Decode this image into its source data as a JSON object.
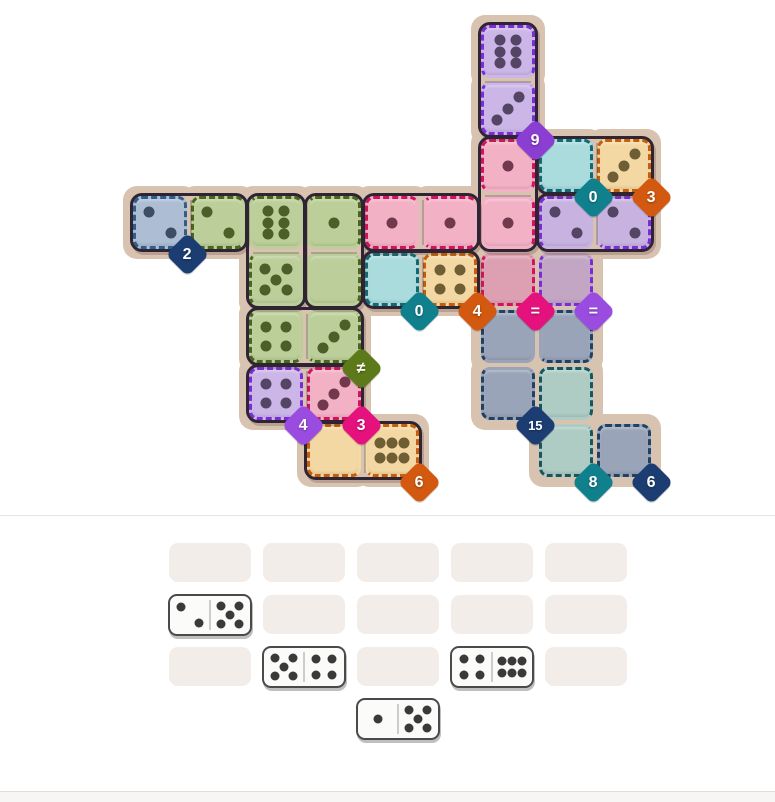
{
  "page": {
    "background": "#ffffff",
    "divider_y": 515,
    "divider_color": "#e8e4e1",
    "footer_y": 791,
    "footer_height": 11,
    "footer_fill": "#f7f6f4",
    "footer_border": "#e2dedb"
  },
  "board": {
    "outline_fill": "#d8c2b0",
    "frame_color": "#2e2433",
    "grid": {
      "origin_x": 131,
      "origin_y": 23,
      "cell_w": 58,
      "cell_h": 57
    },
    "regions": [
      {
        "name": "purple-top",
        "fill": "#cbb6e7",
        "dash": "#7a2cdb",
        "pip_color": "#544565",
        "badge": {
          "label": "9",
          "color": "#8a3ed2",
          "anchor": [
            7,
            2
          ]
        },
        "cells": [
          {
            "c": 7,
            "r": 1,
            "pips": 6,
            "layout": "6v",
            "edges": "trl"
          },
          {
            "c": 7,
            "r": 2,
            "pips": 3,
            "edges": "rbl"
          }
        ]
      },
      {
        "name": "teal-upper",
        "fill": "#aadbdd",
        "dash": "#0f6a75",
        "pip_color": "#1f4a50",
        "badge": {
          "label": "0",
          "color": "#11808d",
          "anchor": [
            8,
            3
          ]
        },
        "cells": [
          {
            "c": 8,
            "r": 3,
            "pips": 0,
            "edges": "trbl"
          }
        ]
      },
      {
        "name": "orange-upper",
        "fill": "#f4d8a3",
        "dash": "#c65d08",
        "pip_color": "#6f5e33",
        "badge": {
          "label": "3",
          "color": "#d2590f",
          "anchor": [
            9,
            3
          ]
        },
        "cells": [
          {
            "c": 9,
            "r": 3,
            "pips": 3,
            "edges": "trbl"
          }
        ]
      },
      {
        "name": "bluegray",
        "fill": "#adbdd3",
        "dash": "#2e5f8c",
        "pip_color": "#3d4e64",
        "badge": {
          "label": "2",
          "color": "#1c3d72",
          "anchor": [
            1,
            4
          ]
        },
        "cells": [
          {
            "c": 1,
            "r": 4,
            "pips": 2,
            "edges": "trbl"
          }
        ]
      },
      {
        "name": "green",
        "fill": "#bccf9a",
        "dash": "#4a661c",
        "pip_color": "#4d5f29",
        "badge": {
          "label": "≠",
          "color": "#5d7a1a",
          "anchor": [
            4,
            6
          ]
        },
        "cells": [
          {
            "c": 2,
            "r": 4,
            "pips": 2,
            "edges": "tbl"
          },
          {
            "c": 3,
            "r": 4,
            "pips": 6,
            "layout": "6v",
            "edges": "t"
          },
          {
            "c": 4,
            "r": 4,
            "pips": 1,
            "edges": "tr"
          },
          {
            "c": 3,
            "r": 5,
            "pips": 5,
            "edges": "l"
          },
          {
            "c": 4,
            "r": 5,
            "pips": 0,
            "edges": "r"
          },
          {
            "c": 3,
            "r": 6,
            "pips": 4,
            "edges": "lb"
          },
          {
            "c": 4,
            "r": 6,
            "pips": 3,
            "edges": "rb"
          }
        ]
      },
      {
        "name": "pink-large",
        "fill": "#f3b1c5",
        "dash": "#d5115e",
        "pip_color": "#71384e",
        "badge": {
          "label": "=",
          "color": "#e5127e",
          "anchor": [
            7,
            5
          ]
        },
        "cells": [
          {
            "c": 7,
            "r": 3,
            "pips": 1,
            "edges": "trl"
          },
          {
            "c": 5,
            "r": 4,
            "pips": 1,
            "edges": "tbl"
          },
          {
            "c": 6,
            "r": 4,
            "pips": 1,
            "edges": "tb"
          },
          {
            "c": 7,
            "r": 4,
            "pips": 1,
            "edges": "r"
          },
          {
            "c": 7,
            "r": 5,
            "pips": null,
            "edges": "rbl",
            "fill": "#dda0b2"
          }
        ]
      },
      {
        "name": "purple-mid",
        "fill": "#c8b3e0",
        "dash": "#7a2cdb",
        "pip_color": "#544565",
        "badge": {
          "label": "=",
          "color": "#9b4ce0",
          "anchor": [
            8,
            5
          ]
        },
        "cells": [
          {
            "c": 8,
            "r": 4,
            "pips": 2,
            "edges": "tl"
          },
          {
            "c": 9,
            "r": 4,
            "pips": 2,
            "edges": "trb"
          },
          {
            "c": 8,
            "r": 5,
            "pips": null,
            "edges": "rbl",
            "fill": "#c2a6c3"
          }
        ]
      },
      {
        "name": "teal-small",
        "fill": "#aadbdd",
        "dash": "#0f6a75",
        "pip_color": "#1f4a50",
        "badge": {
          "label": "0",
          "color": "#11808d",
          "anchor": [
            5,
            5
          ]
        },
        "cells": [
          {
            "c": 5,
            "r": 5,
            "pips": 0,
            "edges": "trbl"
          }
        ]
      },
      {
        "name": "orange-mid",
        "fill": "#f4d8a3",
        "dash": "#c65d08",
        "pip_color": "#6f5e33",
        "badge": {
          "label": "4",
          "color": "#d2590f",
          "anchor": [
            6,
            5
          ]
        },
        "cells": [
          {
            "c": 6,
            "r": 5,
            "pips": 4,
            "edges": "trbl"
          }
        ]
      },
      {
        "name": "gray-large",
        "fill": "#9aa4b8",
        "dash": "#1e4166",
        "pip_color": "#2a3850",
        "badge": {
          "label": "15",
          "color": "#1c3d72",
          "anchor": [
            7,
            7
          ]
        },
        "cells": [
          {
            "c": 7,
            "r": 6,
            "pips": null,
            "edges": "tl"
          },
          {
            "c": 8,
            "r": 6,
            "pips": null,
            "edges": "trb"
          },
          {
            "c": 7,
            "r": 7,
            "pips": null,
            "edges": "rbl"
          }
        ]
      },
      {
        "name": "purple-small",
        "fill": "#cbb6e7",
        "dash": "#7a2cdb",
        "pip_color": "#544565",
        "badge": {
          "label": "4",
          "color": "#9b4ce0",
          "anchor": [
            3,
            7
          ]
        },
        "cells": [
          {
            "c": 3,
            "r": 7,
            "pips": 4,
            "edges": "trbl"
          }
        ]
      },
      {
        "name": "pink-small",
        "fill": "#f3b1c5",
        "dash": "#d5115e",
        "pip_color": "#71384e",
        "badge": {
          "label": "3",
          "color": "#e5127e",
          "anchor": [
            4,
            7
          ]
        },
        "cells": [
          {
            "c": 4,
            "r": 7,
            "pips": 3,
            "edges": "trbl"
          }
        ]
      },
      {
        "name": "teal-lower",
        "fill": "#aecbc4",
        "dash": "#15565f",
        "pip_color": "#23444a",
        "badge": {
          "label": "8",
          "color": "#11808d",
          "anchor": [
            8,
            8
          ]
        },
        "cells": [
          {
            "c": 8,
            "r": 7,
            "pips": null,
            "edges": "trl"
          },
          {
            "c": 8,
            "r": 8,
            "pips": null,
            "edges": "rbl"
          }
        ]
      },
      {
        "name": "orange-lower",
        "fill": "#f4d8a3",
        "dash": "#c65d08",
        "pip_color": "#6f5e33",
        "badge": {
          "label": "6",
          "color": "#d2590f",
          "anchor": [
            5,
            8
          ]
        },
        "cells": [
          {
            "c": 4,
            "r": 8,
            "pips": 0,
            "edges": "tbl"
          },
          {
            "c": 5,
            "r": 8,
            "pips": 6,
            "layout": "6h",
            "edges": "trb"
          }
        ]
      },
      {
        "name": "gray-small",
        "fill": "#9aa4b8",
        "dash": "#1e4166",
        "pip_color": "#2a3850",
        "badge": {
          "label": "6",
          "color": "#1c3d72",
          "anchor": [
            9,
            8
          ]
        },
        "cells": [
          {
            "c": 9,
            "r": 8,
            "pips": null,
            "edges": "trbl"
          }
        ]
      }
    ],
    "placed_dominoes": [
      {
        "a": [
          7,
          1
        ],
        "b": [
          7,
          2
        ]
      },
      {
        "a": [
          8,
          3
        ],
        "b": [
          9,
          3
        ]
      },
      {
        "a": [
          7,
          3
        ],
        "b": [
          7,
          4
        ]
      },
      {
        "a": [
          1,
          4
        ],
        "b": [
          2,
          4
        ]
      },
      {
        "a": [
          3,
          4
        ],
        "b": [
          3,
          5
        ]
      },
      {
        "a": [
          4,
          4
        ],
        "b": [
          4,
          5
        ]
      },
      {
        "a": [
          5,
          4
        ],
        "b": [
          6,
          4
        ]
      },
      {
        "a": [
          8,
          4
        ],
        "b": [
          9,
          4
        ]
      },
      {
        "a": [
          5,
          5
        ],
        "b": [
          6,
          5
        ]
      },
      {
        "a": [
          3,
          6
        ],
        "b": [
          4,
          6
        ]
      },
      {
        "a": [
          3,
          7
        ],
        "b": [
          4,
          7
        ]
      },
      {
        "a": [
          4,
          8
        ],
        "b": [
          5,
          8
        ]
      }
    ]
  },
  "tray": {
    "slot_fill": "#f3edea",
    "slots": [
      {
        "x": 169,
        "y": 543
      },
      {
        "x": 263,
        "y": 543
      },
      {
        "x": 357,
        "y": 543
      },
      {
        "x": 451,
        "y": 543
      },
      {
        "x": 545,
        "y": 543
      },
      {
        "x": 263,
        "y": 595
      },
      {
        "x": 357,
        "y": 595
      },
      {
        "x": 451,
        "y": 595
      },
      {
        "x": 545,
        "y": 595
      },
      {
        "x": 169,
        "y": 647
      },
      {
        "x": 357,
        "y": 647
      },
      {
        "x": 545,
        "y": 647
      }
    ],
    "dominoes": [
      {
        "x": 168,
        "y": 594,
        "left": 2,
        "right": 5
      },
      {
        "x": 262,
        "y": 646,
        "left": 5,
        "right": 4
      },
      {
        "x": 450,
        "y": 646,
        "left": 4,
        "right": 6
      },
      {
        "x": 356,
        "y": 698,
        "left": 1,
        "right": 5
      }
    ]
  }
}
